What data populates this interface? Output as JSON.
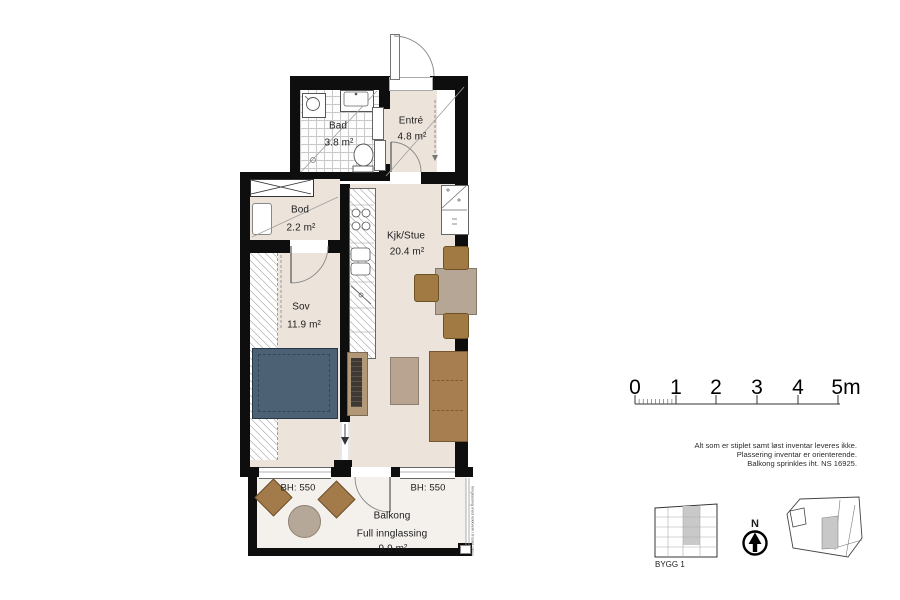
{
  "plan": {
    "rooms": [
      {
        "id": "bad",
        "name": "Bad",
        "area": "3.8 m²"
      },
      {
        "id": "entre",
        "name": "Entré",
        "area": "4.8 m²"
      },
      {
        "id": "bod",
        "name": "Bod",
        "area": "2.2 m²"
      },
      {
        "id": "kjk_stue",
        "name": "Kjk/Stue",
        "area": "20.4 m²"
      },
      {
        "id": "sov",
        "name": "Sov",
        "area": "11.9 m²"
      }
    ],
    "balcony": {
      "name": "Balkong",
      "subtitle": "Full innglassing",
      "area": "9.9 m²",
      "sill_left": "BH: 550",
      "sill_right": "BH: 550",
      "glass_note_line1": "innglassing med rekkverk i",
      "glass_note_line2": "frostet glass"
    }
  },
  "scalebar": {
    "labels": [
      "0",
      "1",
      "2",
      "3",
      "4",
      "5m"
    ]
  },
  "notes": {
    "lines": [
      "Alt som er stiplet samt løst inventar leveres ikke.",
      "Plassering inventar er orienterende.",
      "Balkong sprinkles iht. NS 16925."
    ]
  },
  "legend": {
    "building_label": "BYGG 1",
    "north_label": "N"
  },
  "colors": {
    "wall": "#0e0e0e",
    "floor": "#ece3db",
    "balconyfloor": "#f4f1ed",
    "bed": "#4d6175",
    "sofa": "#a67e50",
    "wood": "#a07a42",
    "tabletop": "#b5a695",
    "bench": "#b39877",
    "ink": "#1c1c1c"
  }
}
